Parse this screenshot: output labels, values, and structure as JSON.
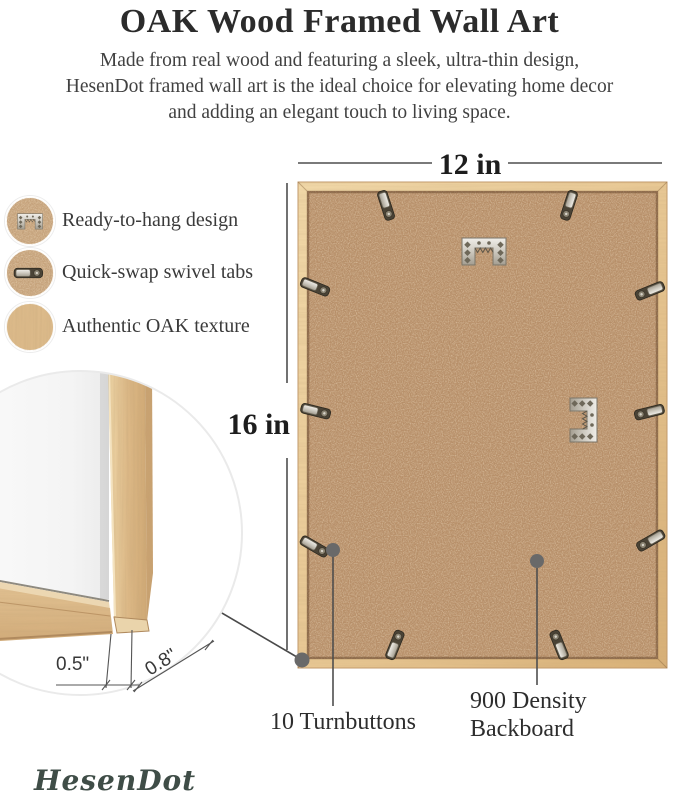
{
  "header": {
    "title": "OAK Wood Framed Wall Art",
    "subtitle_lines": [
      "Made from real wood and featuring a sleek, ultra-thin design,",
      "HesenDot framed wall art is the ideal choice for elevating home decor",
      "and adding an elegant touch to living space."
    ]
  },
  "features": [
    {
      "icon": "sawtooth-hanger-icon",
      "label": "Ready-to-hang design"
    },
    {
      "icon": "swivel-tab-icon",
      "label": "Quick-swap swivel tabs"
    },
    {
      "icon": "oak-texture-icon",
      "label": "Authentic OAK texture"
    }
  ],
  "dimensions": {
    "width_label": "12 in",
    "height_label": "16 in",
    "face_width_label": "0.5\"",
    "depth_label": "0.8\""
  },
  "callouts": {
    "turnbuttons": "10 Turnbuttons",
    "backboard_line1": "900 Density",
    "backboard_line2": "Backboard"
  },
  "hardware": {
    "turnbutton_count": 10,
    "sawtooth_hanger_count": 2
  },
  "brand": {
    "logo_text": "HesenDot"
  },
  "colors": {
    "wood": "#e7c28c",
    "wood_light": "#f1d8a8",
    "backboard": "#b8906a",
    "metal_light": "#efede8",
    "metal_dark": "#4a4336",
    "leader_line": "#4e4e4e",
    "callout_dot": "#696969",
    "text_dark": "#1d1d1d",
    "text_body": "#414141",
    "logo": "#3f4d47"
  }
}
